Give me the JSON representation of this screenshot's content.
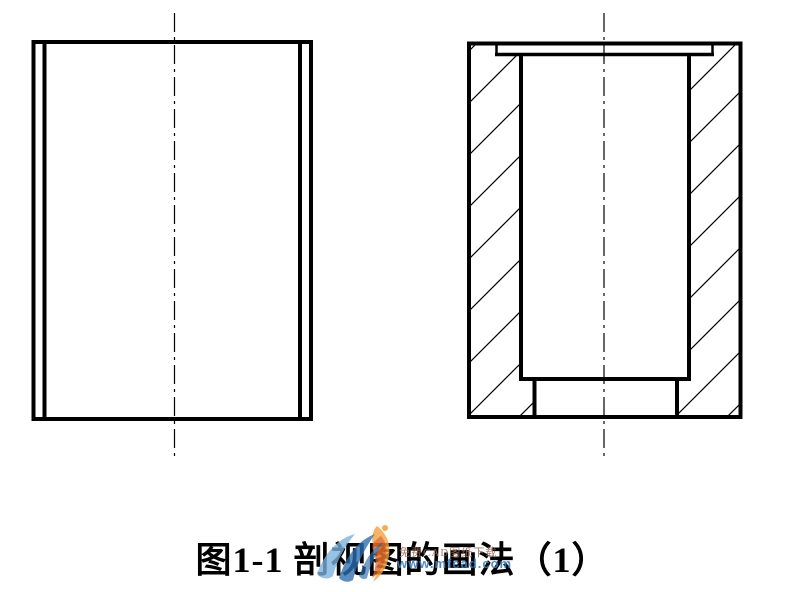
{
  "page": {
    "background": "#ffffff"
  },
  "drawing": {
    "line_color": "#000000",
    "centerline_dash": "19 5 3 5"
  },
  "figure": {
    "caption": "图1-1 剖视图的画法（1）"
  },
  "watermark": {
    "site_text": "免费CAD图纸下载",
    "url_text": "www.mfcad.com",
    "colors": {
      "swoosh_light": "#7bb1dc",
      "swoosh_dark": "#2f6fae",
      "flame_orange": "#f5a03c",
      "flame_red": "#e06424",
      "site_text_color": "#9a6a55",
      "url_color": "#3b7dc0"
    }
  }
}
